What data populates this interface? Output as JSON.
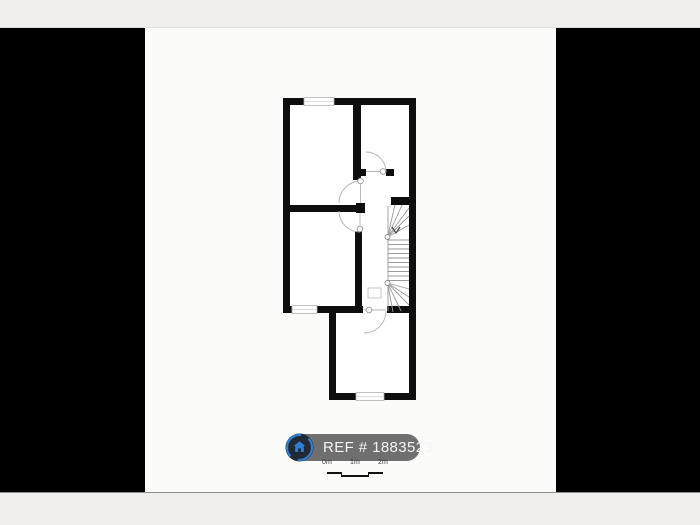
{
  "badge": {
    "ref_label": "REF # 1883523",
    "pill_color": "#6f6f6f",
    "text_color": "#f4f4f4",
    "icon": {
      "name": "house-icon",
      "circle_color": "#212a34",
      "ring_color": "#2e7fd3",
      "house_color": "#2e7fd3"
    }
  },
  "scale_bar": {
    "labels": [
      "0m",
      "1m",
      "2m"
    ]
  },
  "floorplan": {
    "wall_color": "#0e0e0e",
    "background_color": "#ffffff",
    "line_color": "#9a9a9a",
    "elements": {
      "windows": 3,
      "doors": 4,
      "staircase": "winder-staircase",
      "rooms": 4
    }
  },
  "frame": {
    "letterbox_color": "#000000",
    "page_background": "#f0efed",
    "photo_background": "#fbfbfa"
  }
}
